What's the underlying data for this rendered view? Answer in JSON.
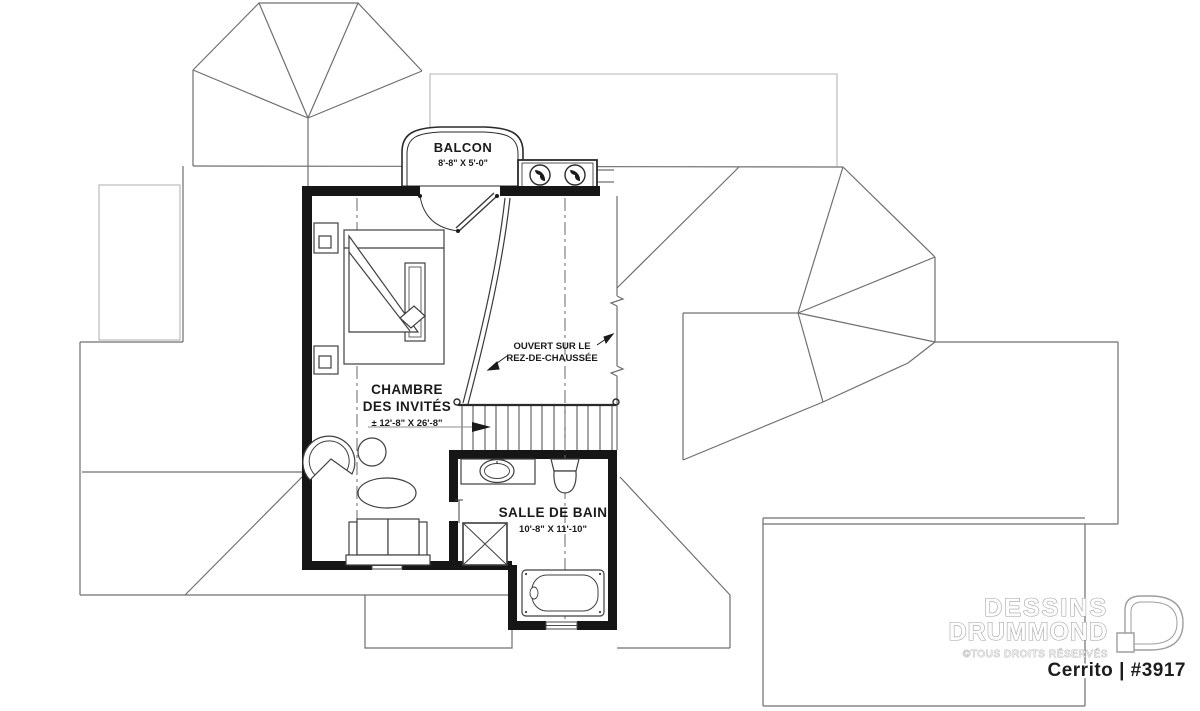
{
  "plan": {
    "balcony": {
      "label": "BALCON",
      "dims": "8'-8\" X 5'-0\""
    },
    "guest_room": {
      "label_line1": "CHAMBRE",
      "label_line2": "DES INVITÉS",
      "dims": "± 12'-8\" X 26'-8\""
    },
    "open_area": {
      "label_line1": "OUVERT SUR LE",
      "label_line2": "REZ-DE-CHAUSSÉE"
    },
    "bathroom": {
      "label": "SALLE DE BAIN",
      "dims": "10'-8\" X 11'-10\""
    }
  },
  "branding": {
    "company_line1": "DESSINS",
    "company_line2": "DRUMMOND",
    "rights_notice": "©TOUS DROITS RÉSERVÉS",
    "plan_name": "Cerrito | #3917"
  },
  "colors": {
    "wall": "#161616",
    "roof_line": "#6f6f6f",
    "faint_line": "#b5b5b5",
    "furniture_line": "#3f3f3f",
    "text": "#1a1a1a",
    "logo_outline": "#9e9e9e"
  }
}
